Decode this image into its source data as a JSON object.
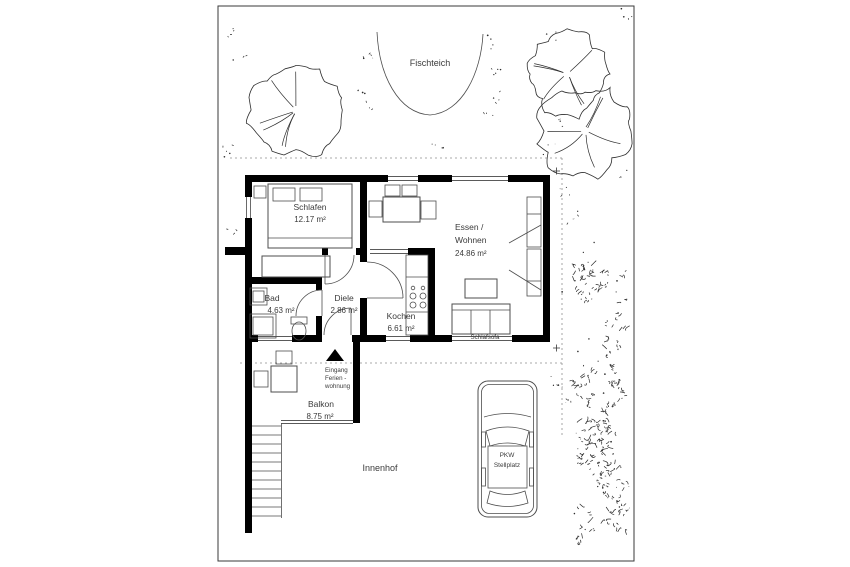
{
  "rooms": {
    "schlafen": {
      "name": "Schlafen",
      "area": "12.17 m²"
    },
    "essen_wohnen": {
      "name_line1": "Essen /",
      "name_line2": "Wohnen",
      "area": "24.86 m²"
    },
    "bad": {
      "name": "Bad",
      "area": "4.63 m²"
    },
    "diele": {
      "name": "Diele",
      "area": "2.86 m²"
    },
    "kochen": {
      "name": "Kochen",
      "area": "6.61 m²"
    },
    "balkon": {
      "name": "Balkon",
      "area": "8.75 m²"
    }
  },
  "labels": {
    "fischteich": "Fischteich",
    "innenhof": "Innenhof",
    "schlafsofa": "Schlafsofa",
    "eingang_line1": "Eingang",
    "eingang_line2": "Ferien -",
    "eingang_line3": "wohnung",
    "pkw_line1": "PKW",
    "pkw_line2": "Stellplatz"
  },
  "colors": {
    "wall": "#000000",
    "furniture_line": "#4d4d4d",
    "vegetation": "#2e2e2e",
    "dashed_boundary": "#8f8f8f",
    "background": "#ffffff",
    "text": "#3b3b3b"
  }
}
